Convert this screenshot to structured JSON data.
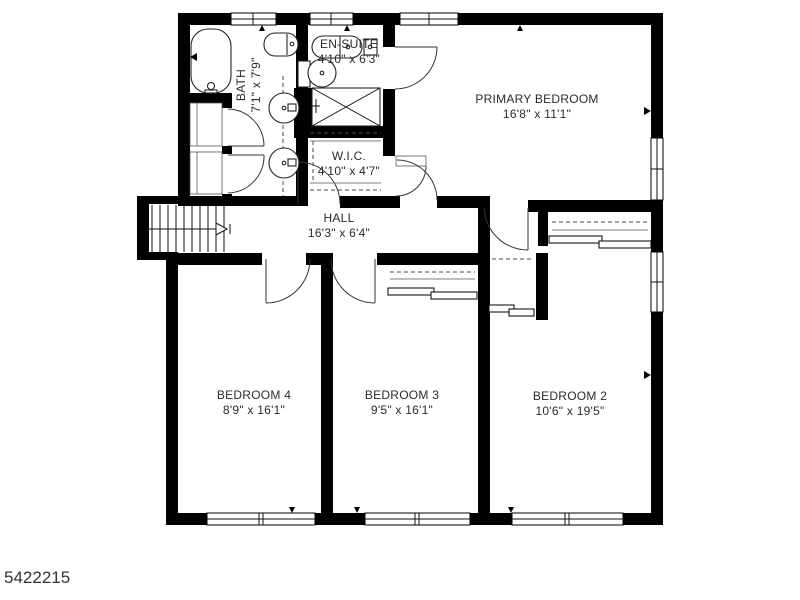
{
  "floorplan": {
    "photo_id": "5422215",
    "rooms": {
      "bath": {
        "name": "BATH",
        "dims": "7'1\" x 7'9\""
      },
      "ensuite": {
        "name": "EN-SUITE",
        "dims": "4'10\" x 6'3\""
      },
      "primary": {
        "name": "PRIMARY BEDROOM",
        "dims": "16'8\" x 11'1\""
      },
      "wic": {
        "name": "W.I.C.",
        "dims": "4'10\" x 4'7\""
      },
      "hall": {
        "name": "HALL",
        "dims": "16'3\" x 6'4\""
      },
      "bedroom4": {
        "name": "BEDROOM 4",
        "dims": "8'9\" x 16'1\""
      },
      "bedroom3": {
        "name": "BEDROOM 3",
        "dims": "9'5\" x 16'1\""
      },
      "bedroom2": {
        "name": "BEDROOM 2",
        "dims": "10'6\" x 19'5\""
      }
    },
    "fixtures": [
      "bathtub",
      "toilet",
      "sink",
      "vanity",
      "shower",
      "staircase",
      "closet",
      "window",
      "door"
    ],
    "colors": {
      "wall": "#000000",
      "line": "#1a1a1a",
      "dash": "#4a4a4a",
      "label": "#2b2b2b",
      "background": "#ffffff"
    }
  }
}
